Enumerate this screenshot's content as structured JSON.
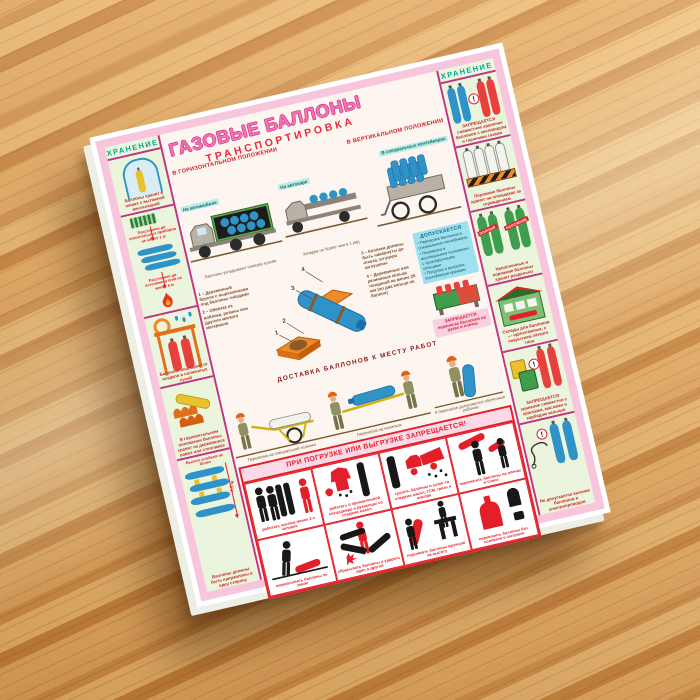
{
  "warn_mark": "!",
  "poster": {
    "title": "ГАЗОВЫЕ БАЛЛОНЫ",
    "subtitle": "ТРАНСПОРТИРОВКА",
    "section_horizontal": "В ГОРИЗОНТАЛЬНОМ ПОЛОЖЕНИИ",
    "section_vertical": "В ВЕРТИКАЛЬНОМ ПОЛОЖЕНИИ",
    "badge_truck": "На автомобиле",
    "badge_autocar": "На автокаре",
    "badge_containers": "В специальных контейнерах",
    "truck_caption": "Баллоны укладывают поперёк кузова",
    "autocar_caption": "Укладка не более чем в 1 ряд",
    "packing_notes": [
      "1 – Деревянный брусок с вырезанными под баллоны гнёздами",
      "2 – Обвязка из войлока, резины или другого мягкого материала",
      "3 – Колпаки должны быть навёрнуты до отказа, штуцера заглушены",
      "4 – Деревянные или резиновые кольца толщиной не менее 25 мм (по два кольца на баллон)"
    ],
    "allowed": {
      "title": "ДОПУСКАЕТСЯ",
      "items": [
        "Перевозка баллонов в специальных контейнерах",
        "Перевозка в вертикальном положении с прокладочными кольцами",
        "Погрузка и выгрузка контейнеров кранами"
      ]
    },
    "delivery_warning": "ЗАПРЕЩАЕТСЯ переноска баллонов на руках и плечах",
    "delivery_heading": "ДОСТАВКА БАЛЛОНОВ К МЕСТУ РАБОТ",
    "delivery_cart_caption": "Перевозка на специальной тележке",
    "delivery_stretcher_caption": "Переноска на носилках",
    "delivery_carry_caption": "К переноске допускаются обученные рабочие",
    "storage_left": {
      "header": "ХРАНЕНИЕ",
      "niche_caption": "Баллоны хранят в нишах с вытяжной вентиляцией",
      "distance_heat": "Расстояние до отопительных приборов не менее 1 м",
      "distance_fire": "Расстояние до источников огня не менее 5 м",
      "shed_caption": "Баллоны защищают от осадков и солнечных лучей",
      "rack_caption": "В горизонтальном положении баллоны хранят на деревянных рамах или стеллажах",
      "stack_label": "Высота штабеля не более",
      "stack_height": "1,5 м",
      "stack_caption": "Баллоны должны быть направлены в одну сторону"
    },
    "storage_right": {
      "header": "ХРАНЕНИЕ",
      "mixed_caption": "ЗАПРЕЩАЕТСЯ совместное хранение баллонов с кислородом и горючими газами",
      "fence_caption": "Порожние баллоны хранят на площадках за ограждением",
      "stamp_full": "ПОЛНЫЕ",
      "stamp_empty": "ПОРОЖНИЕ",
      "separate_caption": "Наполненные и порожние баллоны хранят раздельно",
      "warehouse_caption": "Склады для баллонов — одноэтажные, с покрытием лёгкого типа",
      "paints_caption": "ЗАПРЕЩАЕТСЯ хранение совместно с красками, маслами и карбидом кальция",
      "wires_caption": "Не допускается касание баллонов и электропроводов"
    },
    "prohibition": {
      "title": "ПРИ ПОГРУЗКЕ ИЛИ ВЫГРУЗКЕ ЗАПРЕЩАЕТСЯ!",
      "cells": [
        {
          "caption": "работать числом менее 2-х человек"
        },
        {
          "caption": "работать в промасленной спецодежде и рукавицах со следами масел"
        },
        {
          "caption": "грузить баллоны в кузов со следами масел, ГСМ, грязи и мусора"
        },
        {
          "caption": "переносить баллоны на плечах и спине"
        },
        {
          "caption": "перекатывать баллоны по земле"
        },
        {
          "caption": "сбрасывать баллоны и ударять один о другой"
        },
        {
          "caption": "поднимать баллоны вручную на высоту"
        },
        {
          "caption": "перевозить баллоны без колпаков и заглушек"
        }
      ]
    }
  }
}
